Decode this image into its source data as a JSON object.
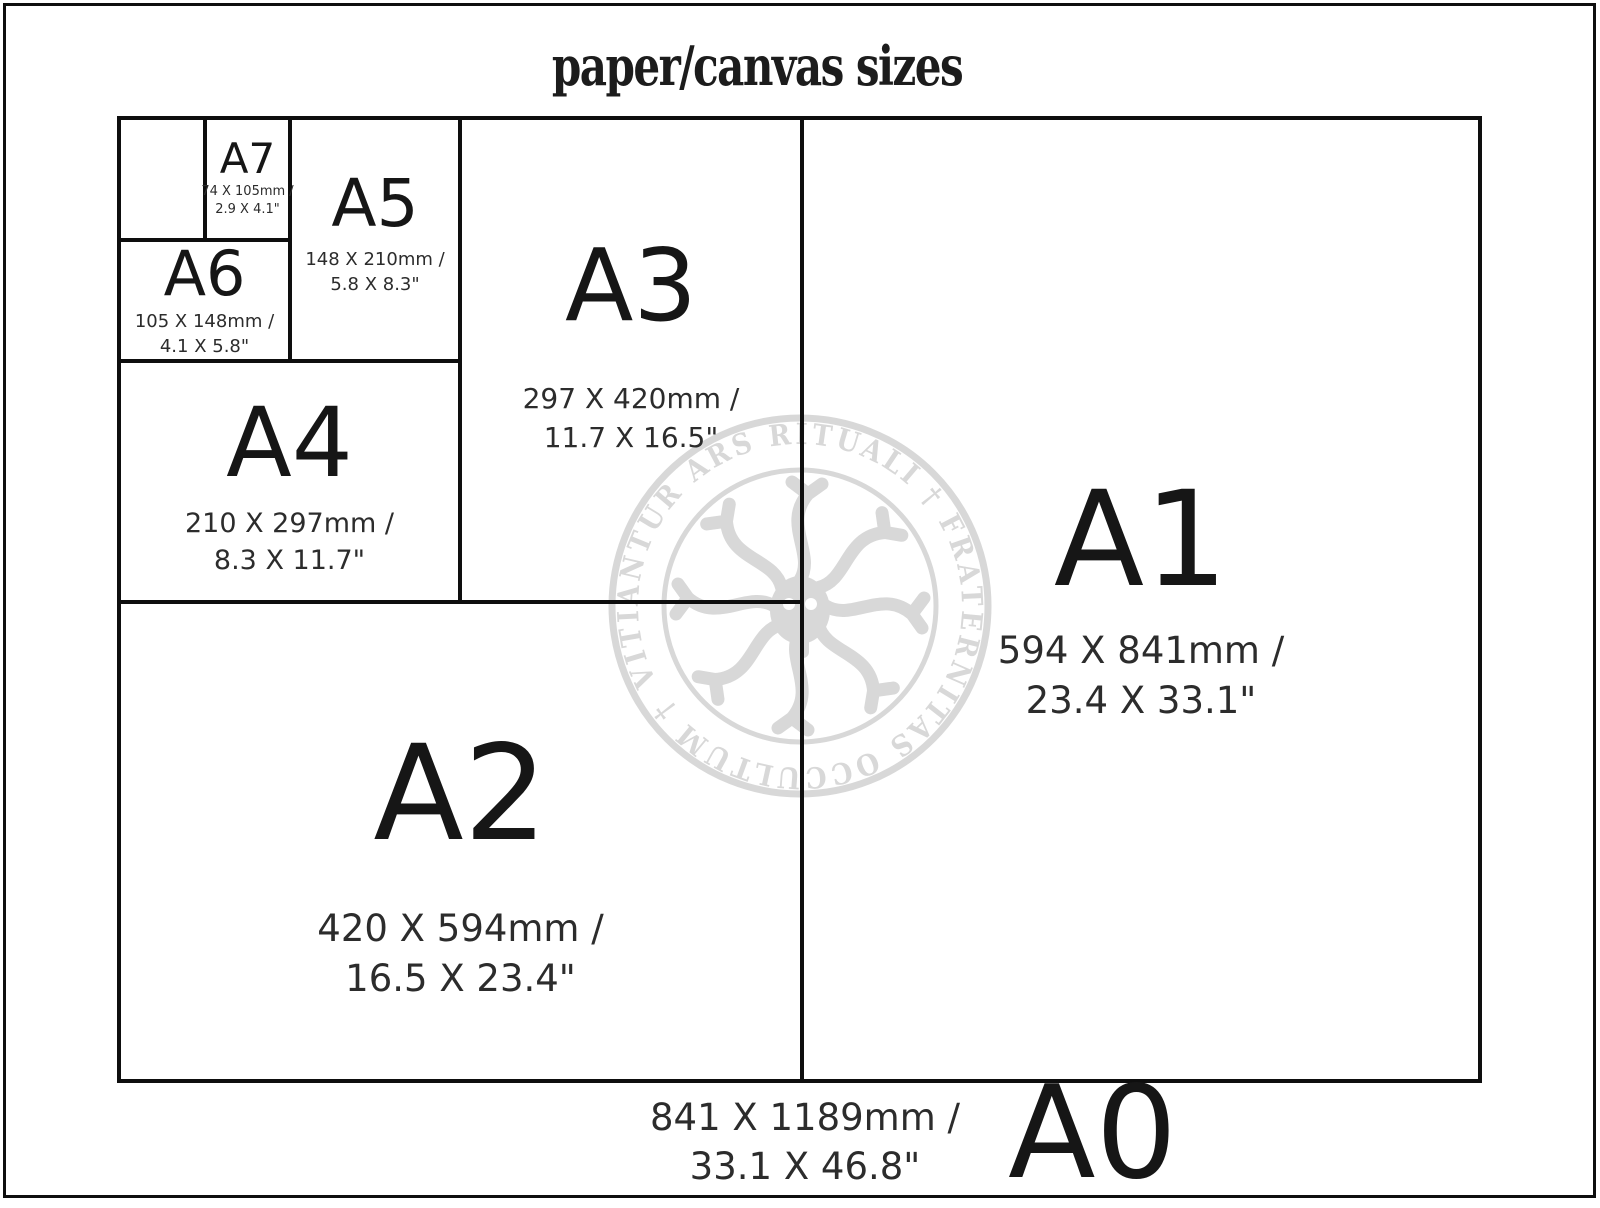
{
  "title": "paper/canvas sizes",
  "sizes": {
    "a0": {
      "label": "A0",
      "mm": "841 X 1189mm /",
      "inches": "33.1 X 46.8\""
    },
    "a1": {
      "label": "A1",
      "mm": "594 X 841mm /",
      "inches": "23.4 X 33.1\""
    },
    "a2": {
      "label": "A2",
      "mm": "420 X 594mm /",
      "inches": "16.5 X 23.4\""
    },
    "a3": {
      "label": "A3",
      "mm": "297 X 420mm /",
      "inches": "11.7 X 16.5\""
    },
    "a4": {
      "label": "A4",
      "mm": "210 X 297mm /",
      "inches": "8.3 X 11.7\""
    },
    "a5": {
      "label": "A5",
      "mm": "148 X 210mm /",
      "inches": "5.8 X 8.3\""
    },
    "a6": {
      "label": "A6",
      "mm": "105 X 148mm /",
      "inches": "4.1 X 5.8\""
    },
    "a7": {
      "label": "A7",
      "mm": "74 X 105mm /",
      "inches": "2.9 X 4.1\""
    }
  },
  "watermark": {
    "ring_text": "VITIANTUR ARS RITUALI † FRATERNITAS OCCULTUM †"
  },
  "colors": {
    "line": "#0e0e0e",
    "text": "#1c1c1c",
    "watermark": "#d8d8d8",
    "background": "#ffffff"
  }
}
